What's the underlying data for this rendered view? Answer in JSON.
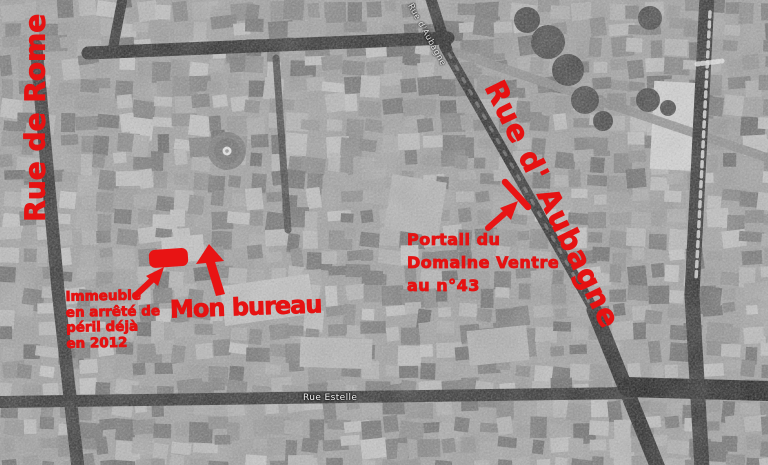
{
  "map": {
    "description": "Black-and-white aerial photo of the Noailles district, annotated in red",
    "labels": {
      "estelle": "Rue Estelle",
      "aubagne_map": "Rue d'Aubagne"
    },
    "annotations": {
      "rue_de_rome": "Rue de Rome",
      "rue_d_aubagne": "Rue d' Aubagne",
      "mon_bureau": "Mon bureau",
      "immeuble": {
        "line1": "Immeuble",
        "line2": "en arrêté de",
        "line3": "péril déjà",
        "line4": "en 2012"
      },
      "portail": {
        "line1": "Portail du",
        "line2": "Domaine Ventre",
        "line3": "au n°43"
      }
    },
    "colors": {
      "annotation_red": "#e61212",
      "street_dark": "#262626",
      "ground_gray": "#a2a2a2"
    }
  }
}
